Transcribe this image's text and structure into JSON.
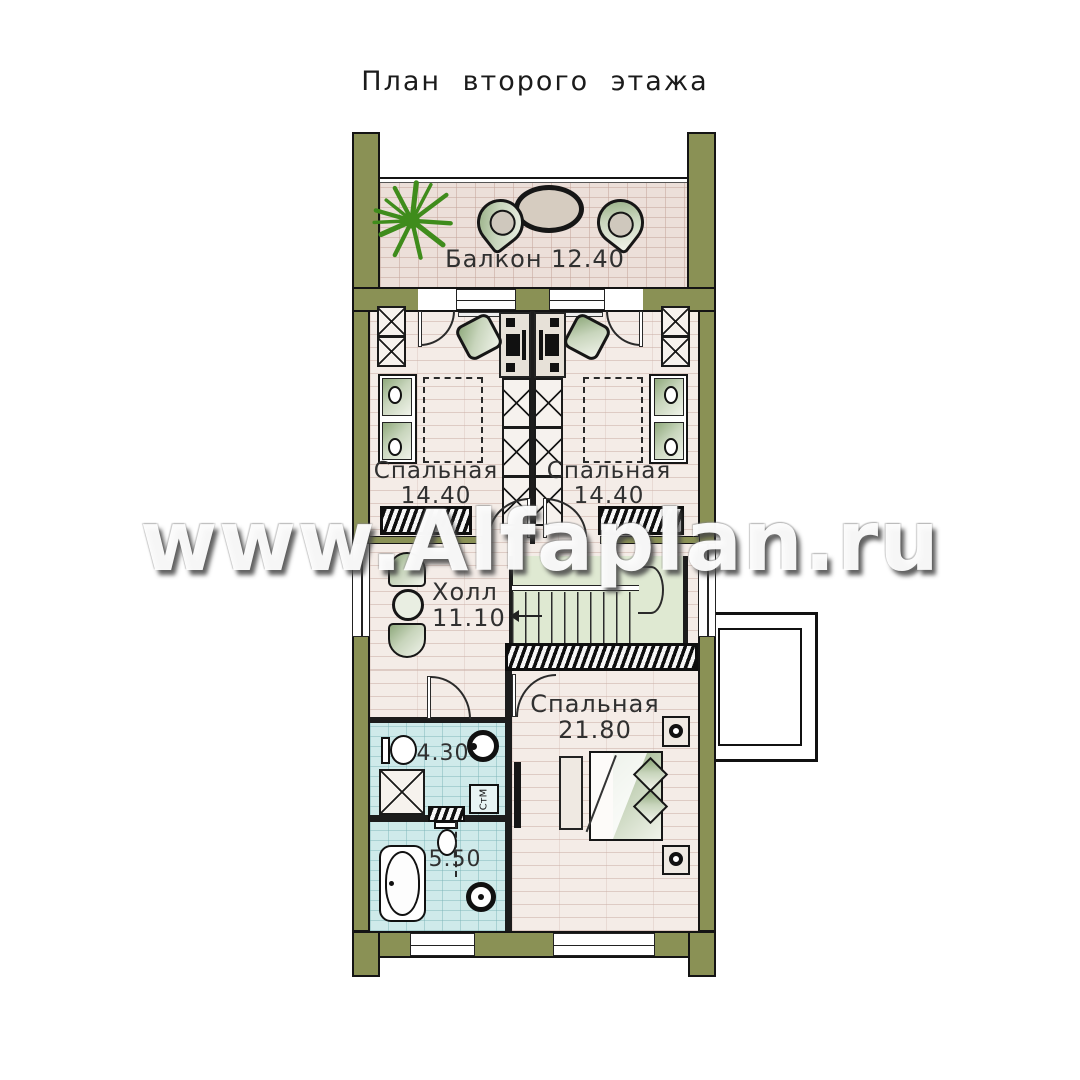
{
  "title": "План второго этажа",
  "watermark": "www.Alfaplan.ru",
  "rooms": {
    "balcony": {
      "name": "Балкон",
      "area": "12.40"
    },
    "bedroom_left": {
      "name": "Спальная",
      "area": "14.40"
    },
    "bedroom_right": {
      "name": "Спальная",
      "area": "14.40"
    },
    "hall": {
      "name": "Холл",
      "area": "11.10"
    },
    "master": {
      "name": "Спальная",
      "area": "21.80"
    },
    "bath_upper": {
      "area": "4.30"
    },
    "bath_lower": {
      "area": "5.50"
    }
  },
  "appliances": {
    "washing_machine": "СтМ"
  },
  "colors": {
    "wall": "#8a9155",
    "plant": "#3f8c1c",
    "wood_floor": "#f4ece7",
    "balcony_floor": "#ecdfd9",
    "bath_floor": "#cfeaea",
    "stair_floor": "#dfe9d2"
  }
}
